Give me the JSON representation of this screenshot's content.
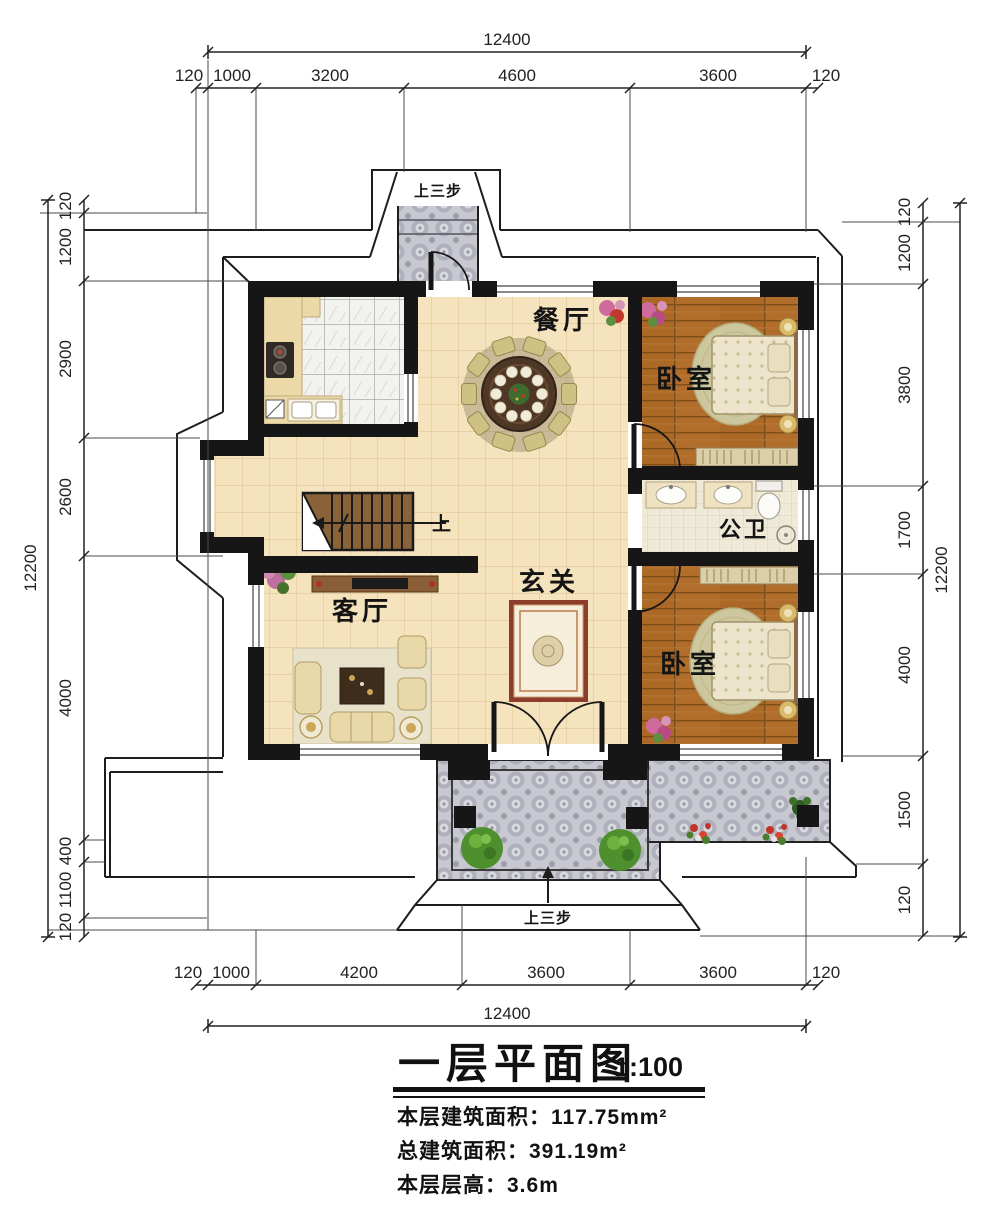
{
  "drawing_title": {
    "text": "一层平面图",
    "scale": "1:100"
  },
  "stats": {
    "floor_area": "本层建筑面积：117.75mm²",
    "total_area": "总建筑面积：391.19m²",
    "floor_height": "本层层高：3.6m"
  },
  "rooms": {
    "dining": "餐厅",
    "bedroom_top": "卧室",
    "bedroom_bottom": "卧室",
    "bathroom": "公卫",
    "foyer": "玄关",
    "living": "客厅"
  },
  "annotations": {
    "stairs_up": "上",
    "steps_top": "上三步",
    "steps_bottom": "上三步"
  },
  "dimensions": {
    "overall_width": "12400",
    "overall_height": "12200",
    "top": [
      "120",
      "1000",
      "3200",
      "4600",
      "3600",
      "120"
    ],
    "bottom": [
      "120",
      "1000",
      "4200",
      "3600",
      "3600",
      "120"
    ],
    "left": [
      "120",
      "1200",
      "2900",
      "2600",
      "4000",
      "400",
      "1100",
      "120"
    ],
    "right": [
      "120",
      "1200",
      "3800",
      "1700",
      "4000",
      "1500",
      "120"
    ]
  },
  "colors": {
    "wall": "#161616",
    "tile_floor": "#f4e3bc",
    "wood_floor": "#b06d2b",
    "terrace": "#c7c8d0",
    "rug_border": "#8e3c2b"
  }
}
